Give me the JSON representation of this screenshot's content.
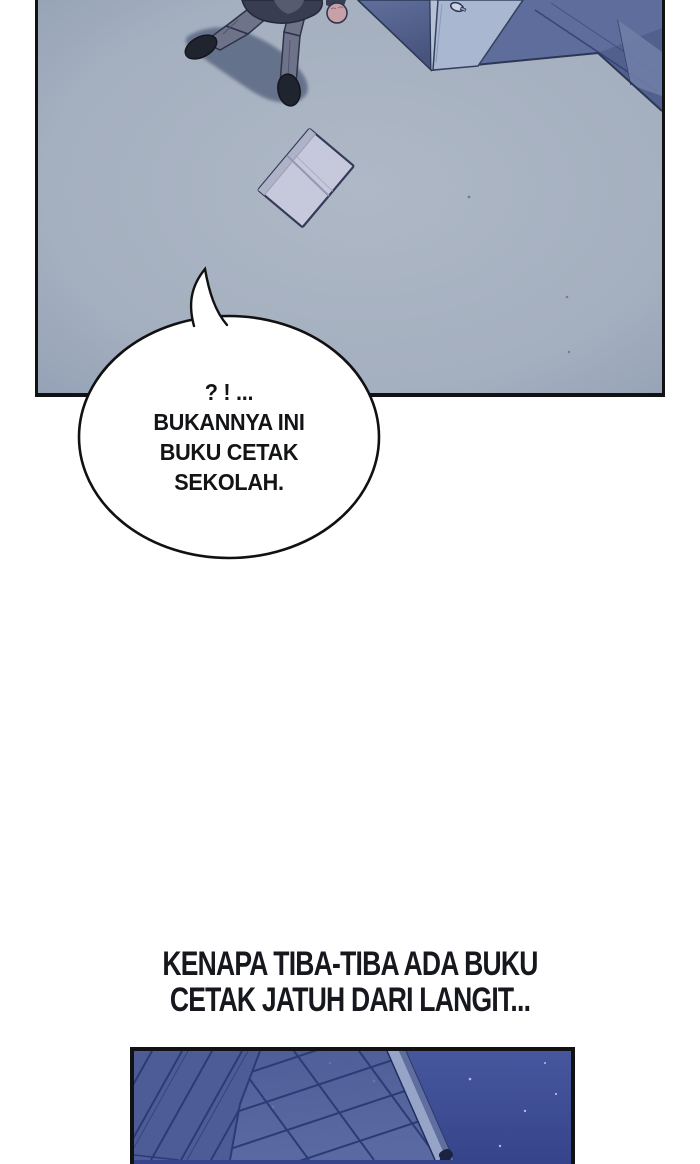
{
  "speech_bubble": {
    "lines": [
      "? ! ...",
      "BUKANNYA INI",
      "BUKU CETAK",
      "SEKOLAH."
    ]
  },
  "narration": {
    "lines": [
      "KENAPA TIBA-TIBA ADA BUKU",
      "CETAK JATUH DARI LANGIT..."
    ]
  },
  "palette": {
    "page-bg": "#ffffff",
    "panel-border": "#121212",
    "floor-light": "#aab5c3",
    "floor-dark": "#8d9cb2",
    "wall": "#5e6d9b",
    "wall-deep": "#4d5c8a",
    "door-face": "#a9b7d1",
    "door-edge": "#b6c1d6",
    "ink-line": "#2c3754",
    "char-shadow": "#5d6a84",
    "pants": "#6e7389",
    "jacket": "#383d52",
    "shoe": "#20242f",
    "skin": "#c7a0a9",
    "book-page": "#c5c9db",
    "book-edge": "#afb3c8",
    "book-outline": "#343a58",
    "sky-top": "#47579e",
    "sky-bottom": "#36458b",
    "facade": "#54639c",
    "facade-left": "#4d5c96",
    "facade-line": "#2b3b73",
    "edge-light": "#96a4c7",
    "edge-mid": "#5f6e9e",
    "star": "#c8d0e8",
    "bubble-fill": "#ffffff",
    "bubble-stroke": "#111111",
    "bubble-text": "#131416",
    "narration-text": "#16181d"
  }
}
